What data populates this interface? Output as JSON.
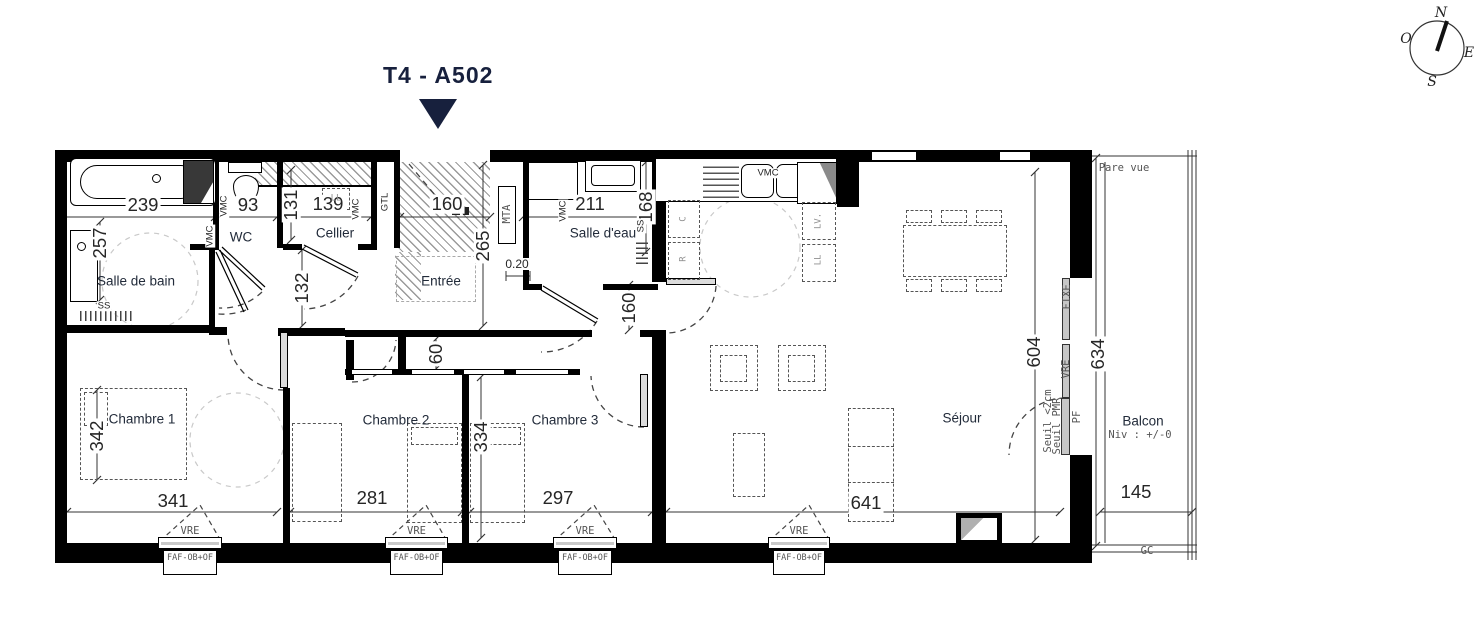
{
  "title": "T4 -  A502",
  "colors": {
    "accent_navy": "#17203d",
    "wall": "#000000",
    "hatch_gray": "#9a9a9a"
  },
  "rooms": [
    {
      "name": "Salle de bain",
      "x": 136,
      "y": 281
    },
    {
      "name": "WC",
      "x": 241,
      "y": 237
    },
    {
      "name": "Cellier",
      "x": 335,
      "y": 233
    },
    {
      "name": "Entrée",
      "x": 441,
      "y": 281
    },
    {
      "name": "Salle d'eau",
      "x": 603,
      "y": 233
    },
    {
      "name": "Chambre 1",
      "x": 142,
      "y": 419
    },
    {
      "name": "Chambre 2",
      "x": 396,
      "y": 420
    },
    {
      "name": "Chambre 3",
      "x": 565,
      "y": 420
    },
    {
      "name": "Séjour",
      "x": 962,
      "y": 418
    },
    {
      "name": "Balcon",
      "x": 1143,
      "y": 421
    }
  ],
  "dims": [
    {
      "t": "239",
      "x": 143,
      "y": 205,
      "cls": "dim"
    },
    {
      "t": "93",
      "x": 248,
      "y": 205,
      "cls": "dim"
    },
    {
      "t": "139",
      "x": 328,
      "y": 204,
      "cls": "dim"
    },
    {
      "t": "160",
      "x": 447,
      "y": 204,
      "cls": "dim"
    },
    {
      "t": "211",
      "x": 590,
      "y": 204,
      "cls": "dim"
    },
    {
      "t": "341",
      "x": 173,
      "y": 501,
      "cls": "dim"
    },
    {
      "t": "281",
      "x": 372,
      "y": 498,
      "cls": "dim"
    },
    {
      "t": "297",
      "x": 558,
      "y": 498,
      "cls": "dim"
    },
    {
      "t": "641",
      "x": 866,
      "y": 503,
      "cls": "dim"
    },
    {
      "t": "145",
      "x": 1136,
      "y": 492,
      "cls": "dim"
    },
    {
      "t": "0.20",
      "x": 517,
      "y": 264,
      "cls": "dims"
    },
    {
      "t": "131",
      "x": 291,
      "y": 205,
      "cls": "dim v"
    },
    {
      "t": "257",
      "x": 100,
      "y": 243,
      "cls": "dim v"
    },
    {
      "t": "265",
      "x": 483,
      "y": 246,
      "cls": "dim v"
    },
    {
      "t": "168",
      "x": 646,
      "y": 207,
      "cls": "dim v"
    },
    {
      "t": "132",
      "x": 302,
      "y": 288,
      "cls": "dim v"
    },
    {
      "t": "160",
      "x": 629,
      "y": 308,
      "cls": "dim v"
    },
    {
      "t": "60",
      "x": 436,
      "y": 354,
      "cls": "dim v"
    },
    {
      "t": "334",
      "x": 481,
      "y": 437,
      "cls": "dim v"
    },
    {
      "t": "342",
      "x": 97,
      "y": 436,
      "cls": "dim v"
    },
    {
      "t": "604",
      "x": 1034,
      "y": 352,
      "cls": "dim v"
    },
    {
      "t": "634",
      "x": 1098,
      "y": 354,
      "cls": "dim v"
    }
  ],
  "labels": [
    {
      "n": "pare-vue-label",
      "t": "Pare vue",
      "x": 1124,
      "y": 168,
      "cls": "mono"
    },
    {
      "n": "gc-label",
      "t": "GC",
      "x": 1147,
      "y": 551,
      "cls": "mono"
    },
    {
      "n": "balcony-level-label",
      "t": "Niv : +/-0",
      "x": 1140,
      "y": 435,
      "cls": "mono"
    },
    {
      "n": "fixe-window-label",
      "t": "FIXE",
      "x": 1067,
      "y": 297,
      "cls": "mono v"
    },
    {
      "n": "vre-bay-label",
      "t": "VRE",
      "x": 1066,
      "y": 369,
      "cls": "mono v"
    },
    {
      "n": "pf-door-label",
      "t": "PF",
      "x": 1077,
      "y": 417,
      "cls": "mono v"
    },
    {
      "n": "seuil-2cm-label",
      "t": "Seuil <2cm",
      "x": 1048,
      "y": 421,
      "cls": "mono v"
    },
    {
      "n": "seuil-pmr-label",
      "t": "Seuil PMR",
      "x": 1057,
      "y": 426,
      "cls": "mono v"
    },
    {
      "n": "mta-label",
      "t": "MTA",
      "x": 507,
      "y": 214,
      "cls": "mono v"
    },
    {
      "n": "gtl-label",
      "t": "GTL",
      "x": 385,
      "y": 202,
      "cls": "tiny v"
    },
    {
      "n": "vmc-label-sdb",
      "t": "VMC",
      "x": 210,
      "y": 236,
      "cls": "tiny v"
    },
    {
      "n": "vmc-label-wc",
      "t": "VMC",
      "x": 224,
      "y": 206,
      "cls": "tiny v"
    },
    {
      "n": "vmc-label-cellier",
      "t": "VMC",
      "x": 356,
      "y": 209,
      "cls": "tiny v"
    },
    {
      "n": "vmc-label-salle-eau",
      "t": "VMC",
      "x": 563,
      "y": 211,
      "cls": "tiny v"
    },
    {
      "n": "vmc-label-kitchen",
      "t": "VMC",
      "x": 768,
      "y": 173,
      "cls": "tiny"
    },
    {
      "n": "ss-label-sdb",
      "t": "SS",
      "x": 104,
      "y": 306,
      "cls": "tiny"
    },
    {
      "n": "ss-label-salle-eau",
      "t": "SS",
      "x": 641,
      "y": 226,
      "cls": "tiny v"
    },
    {
      "n": "appliance-c-label",
      "t": "C",
      "x": 684,
      "y": 219,
      "cls": "appl v"
    },
    {
      "n": "appliance-r-label",
      "t": "R",
      "x": 684,
      "y": 259,
      "cls": "appl v"
    },
    {
      "n": "appliance-lv-label",
      "t": "LV.",
      "x": 819,
      "y": 221,
      "cls": "appl v"
    },
    {
      "n": "appliance-ll-label",
      "t": "LL",
      "x": 819,
      "y": 260,
      "cls": "appl v"
    },
    {
      "n": "cellier-ll-label",
      "t": "LL",
      "x": 336,
      "y": 199,
      "cls": "appl"
    },
    {
      "n": "compass-n",
      "t": "N",
      "x": 1441,
      "y": 13,
      "cls": "compass"
    },
    {
      "n": "compass-o",
      "t": "O",
      "x": 1406,
      "y": 39,
      "cls": "compass"
    },
    {
      "n": "compass-e",
      "t": "E",
      "x": 1469,
      "y": 53,
      "cls": "compass"
    },
    {
      "n": "compass-s",
      "t": "S",
      "x": 1432,
      "y": 82,
      "cls": "compass"
    }
  ],
  "windows": [
    {
      "x": 158,
      "w": 64,
      "vre": "VRE",
      "faf": "FAF-OB+OF"
    },
    {
      "x": 385,
      "w": 63,
      "vre": "VRE",
      "faf": "FAF-OB+OF"
    },
    {
      "x": 553,
      "w": 64,
      "vre": "VRE",
      "faf": "FAF-OB+OF"
    },
    {
      "x": 768,
      "w": 62,
      "vre": "VRE",
      "faf": "FAF-OB+OF"
    }
  ]
}
